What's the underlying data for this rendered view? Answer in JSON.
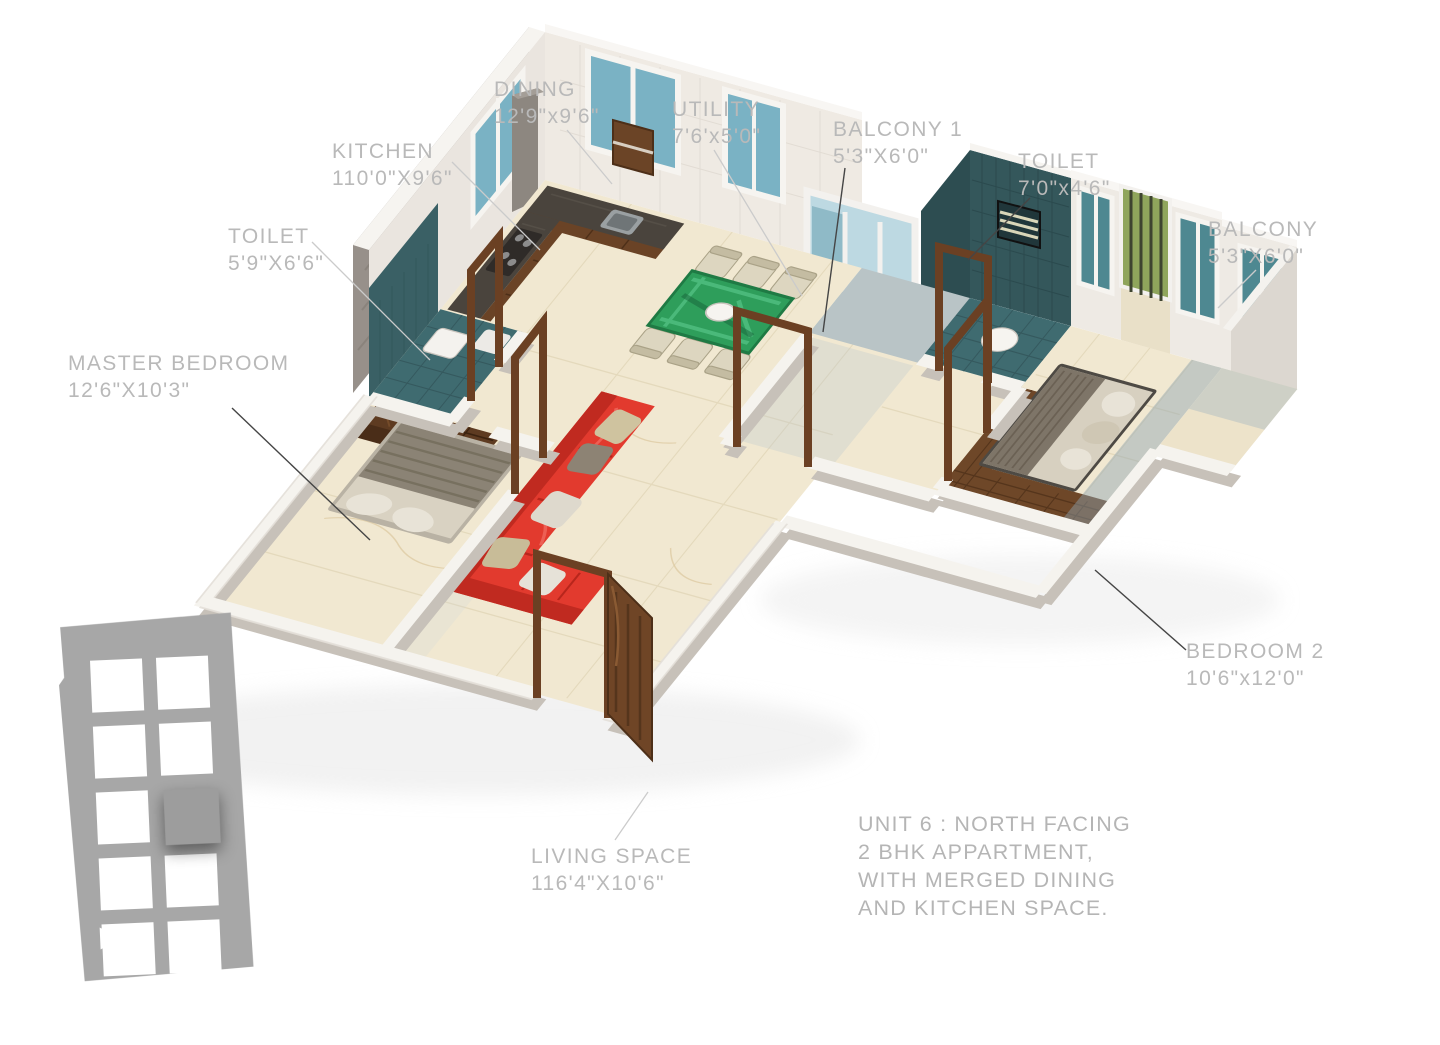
{
  "scene": "3D rendered isometric floor plan of apartment unit",
  "labels": [
    {
      "id": "kitchen",
      "name": "KITCHEN",
      "dims": "110'0\"X9'6\""
    },
    {
      "id": "dining",
      "name": "DINING",
      "dims": "12'9\"x9'6\""
    },
    {
      "id": "utility",
      "name": "UTILITY",
      "dims": "7'6'x5'0\""
    },
    {
      "id": "balcony-1",
      "name": "BALCONY 1",
      "dims": "5'3\"X6'0\""
    },
    {
      "id": "toilet-right",
      "name": "TOILET",
      "dims": "7'0\"x4'6\""
    },
    {
      "id": "balcony-right",
      "name": "BALCONY",
      "dims": "5'3\"X6'0\""
    },
    {
      "id": "toilet-left",
      "name": "TOILET",
      "dims": "5'9\"X6'6\""
    },
    {
      "id": "master-bedroom",
      "name": "MASTER BEDROOM",
      "dims": "12'6\"X10'3\""
    },
    {
      "id": "bedroom-2",
      "name": "BEDROOM 2",
      "dims": "10'6\"x12'0\""
    },
    {
      "id": "living-space",
      "name": "LIVING SPACE",
      "dims": "116'4\"X10'6\""
    }
  ],
  "unit_note": {
    "line1": "UNIT 6 : NORTH FACING",
    "line2": "2 BHK APPARTMENT,",
    "line3": "WITH MERGED DINING",
    "line4": "AND KITCHEN SPACE."
  },
  "north_label": "N",
  "locator": {
    "rows": 5,
    "cols": 2,
    "highlighted_cell": "row 3, column 2"
  },
  "colors": {
    "label_text": "#b9b9b9",
    "leader_light": "#cbcbcb",
    "leader_dark": "#454545",
    "floor_cream": "#f1e8d1",
    "toilet_teal": "#34575b",
    "wood_brown": "#6b4326",
    "sofa_red": "#e23a2e",
    "table_green": "#2e9e5b",
    "glass_blue": "#8fbac7",
    "louver_green": "#94a55c",
    "locator_gray": "#a7a7a7"
  }
}
